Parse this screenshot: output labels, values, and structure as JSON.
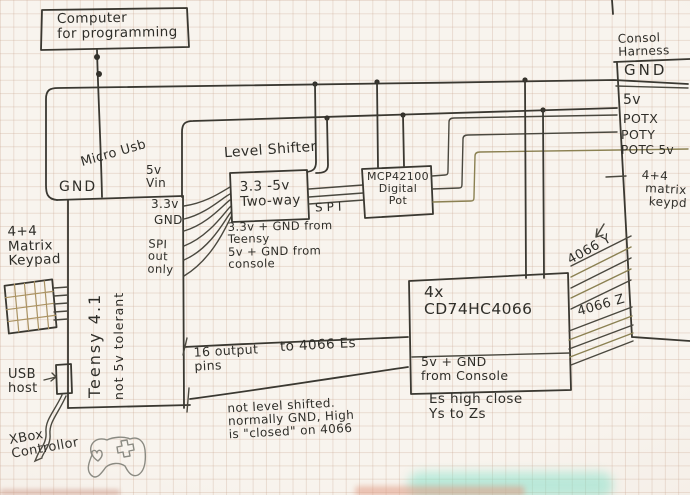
{
  "computer": {
    "label": "Computer\nfor programming"
  },
  "teensy": {
    "name": "Teensy 4.1",
    "note": "not 5v tolerant",
    "micro_usb": "Micro Usb",
    "gnd_top": "GND",
    "vin": "5v\nVin",
    "v33": "3.3v",
    "gnd_right": "GND",
    "spi_out": "SPI\nout\nonly"
  },
  "keypad_left": {
    "label": "4+4\nMatrix\nKeypad"
  },
  "usb_host": {
    "label": "USB\nhost"
  },
  "xbox": {
    "label": "XBox\nControllor"
  },
  "level_shifter": {
    "title": "Level Shifter",
    "box": "3.3 -5v\nTwo-way",
    "spi": "SPI",
    "note": "3.3v + GND from\nTeensy\n5v + GND from\nconsole"
  },
  "digital_pot": {
    "label": "MCP42100\nDigital\nPot"
  },
  "pins_bus": {
    "left": "16 output\npins",
    "right": "to 4066 Es"
  },
  "shift_note": "not level shifted.\nnormally GND, High\nis \"closed\" on 4066",
  "hc4066": {
    "title": "4x\nCD74HC4066",
    "power": "5v + GND\nfrom Console",
    "note": "Es high close\nYs to Zs",
    "y_label": "4066 Y",
    "z_label": "4066 Z"
  },
  "harness": {
    "title": "Consol\nHarness",
    "pins": [
      "GND",
      "5v",
      "POTX",
      "POTY",
      "POTC 5v"
    ],
    "keypad": "4+4\n matrix\n  keypd"
  },
  "colors": {
    "ink": "#3a3831",
    "olive": "#8b8152",
    "paper": "#f8f4ee",
    "teal_smudge": "#6fe0c6"
  }
}
